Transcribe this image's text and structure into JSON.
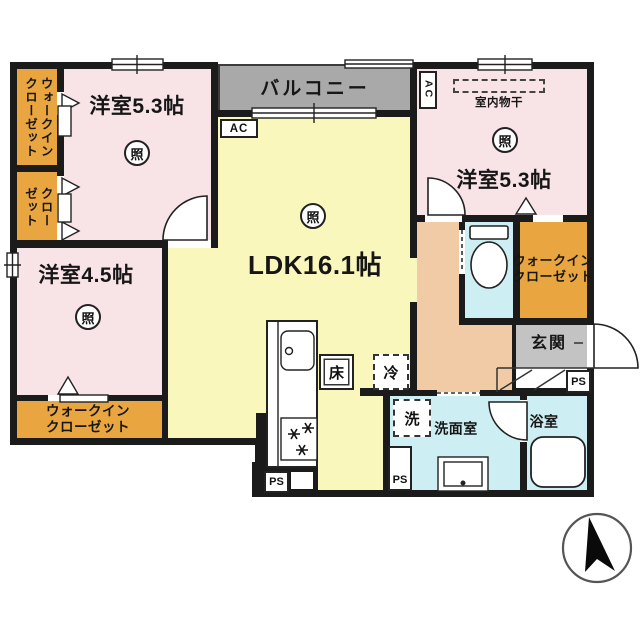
{
  "meta": {
    "type": "floor-plan",
    "description": "2LDK apartment floor plan with walk-in closets"
  },
  "colors": {
    "wall": "#1b1b1b",
    "pink": "#f8e3e7",
    "orange": "#e9a53f",
    "yellow": "#faf7bd",
    "gray-balcony": "#a9a9a9",
    "gray-genkan": "#c3c3c3",
    "cyan": "#cdeef2",
    "tan": "#f1cba5",
    "line": "#222222"
  },
  "rooms": {
    "balcony": {
      "label": "バルコニー"
    },
    "bedroom_nw": {
      "label": "洋室5.3帖"
    },
    "bedroom_ne": {
      "label": "洋室5.3帖"
    },
    "bedroom_w": {
      "label": "洋室4.5帖"
    },
    "ldk": {
      "label": "LDK16.1帖"
    },
    "wic_nw": {
      "label": "ウォークイン\nクローゼット"
    },
    "closet_w": {
      "label": "クロー\nゼット"
    },
    "wic_sw": {
      "label": "ウォークイン\nクローゼット"
    },
    "wic_e": {
      "label": "ウォークイン\nクローゼット"
    },
    "genkan": {
      "label": "玄関"
    },
    "washroom": {
      "label": "洗面室"
    },
    "bathroom": {
      "label": "浴室"
    }
  },
  "fixtures": {
    "indoor_drying": "室内物干",
    "floor_storage": "床",
    "refrigerator": "冷",
    "washer": "洗",
    "light": "照",
    "ac": "AC",
    "ps": "PS"
  }
}
